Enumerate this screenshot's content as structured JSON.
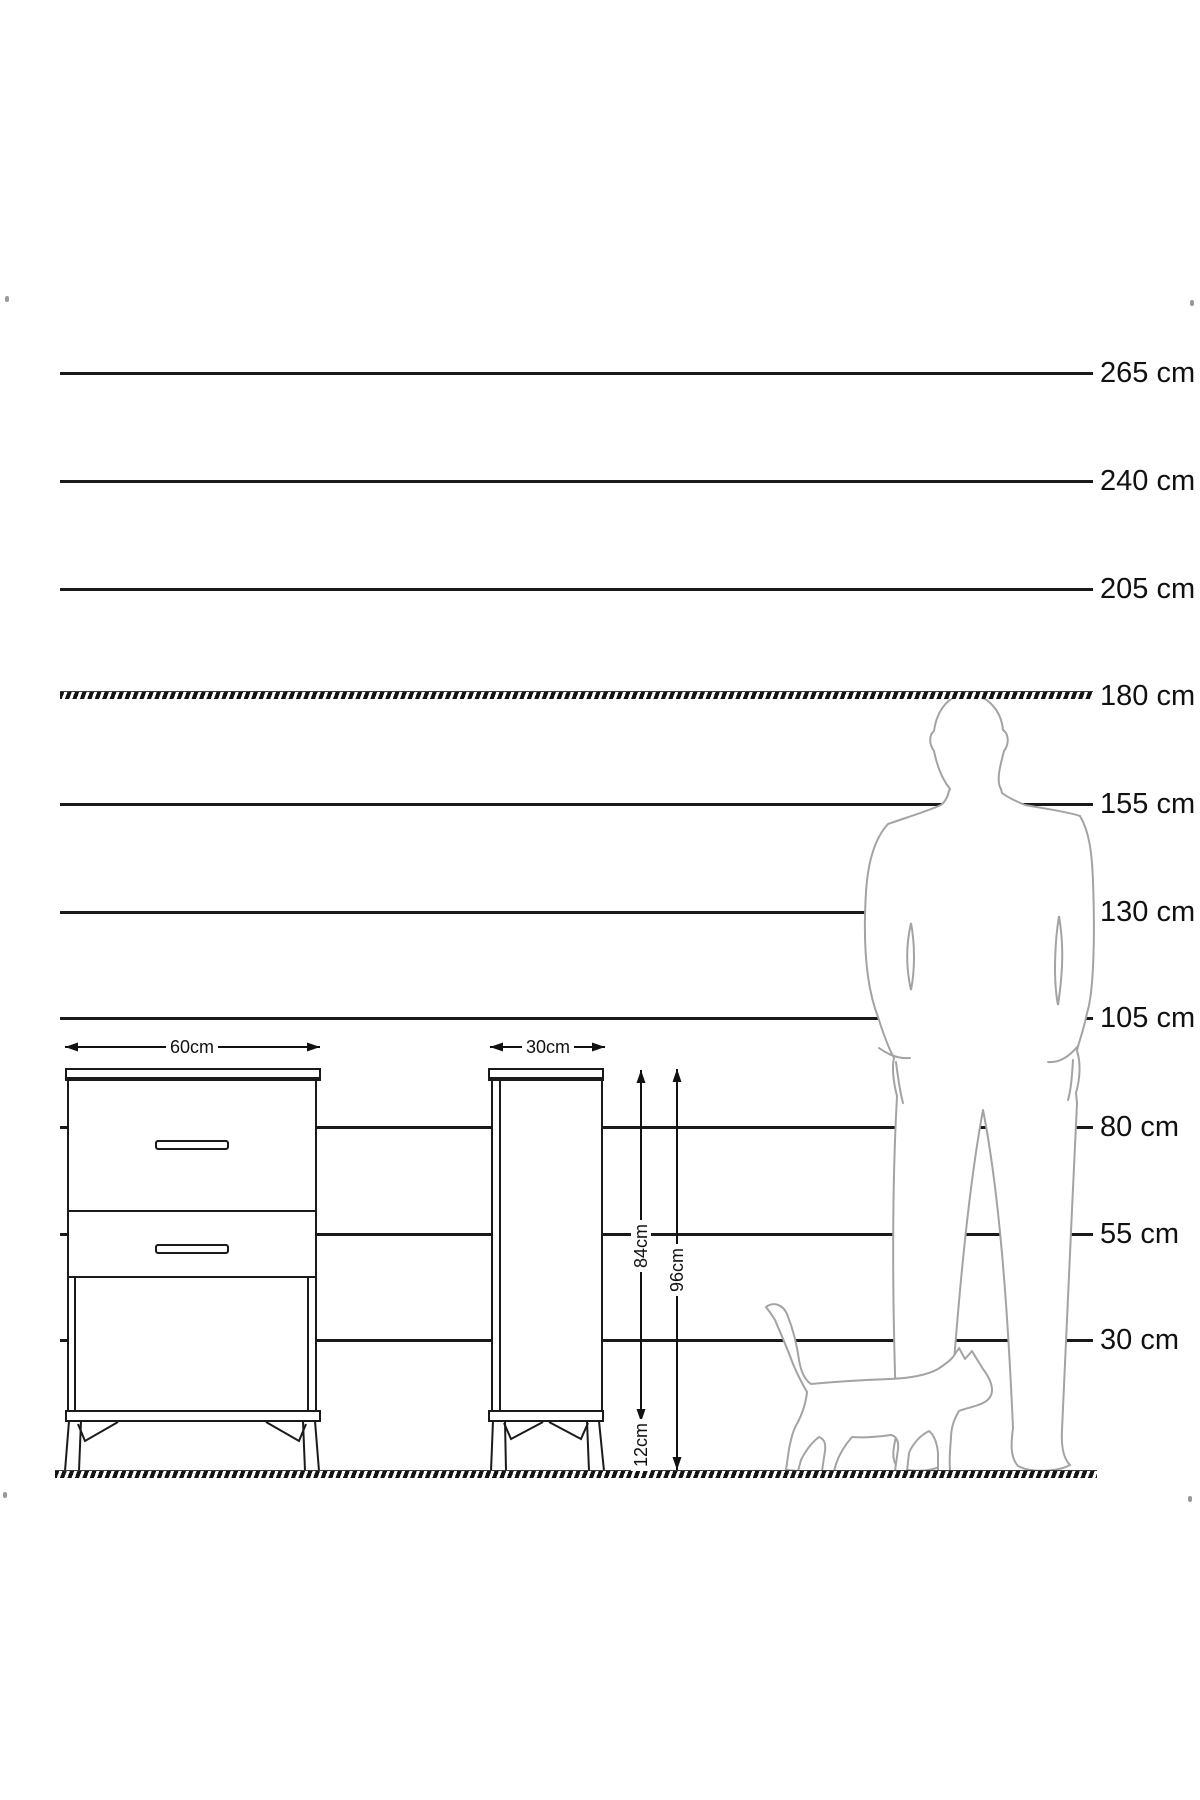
{
  "height_scale": {
    "labels": [
      "265 cm",
      "240 cm",
      "205 cm",
      "180 cm",
      "155 cm",
      "130 cm",
      "105 cm",
      "80 cm",
      "55 cm",
      "30 cm"
    ]
  },
  "furniture_dimensions": {
    "front_width": "60cm",
    "side_depth": "30cm",
    "carcass_height": "84cm",
    "total_height": "96cm",
    "leg_height": "12cm"
  },
  "colors": {
    "line": "#1a1a1a",
    "silhouette_outline": "#a3a3a3",
    "background": "#ffffff"
  }
}
